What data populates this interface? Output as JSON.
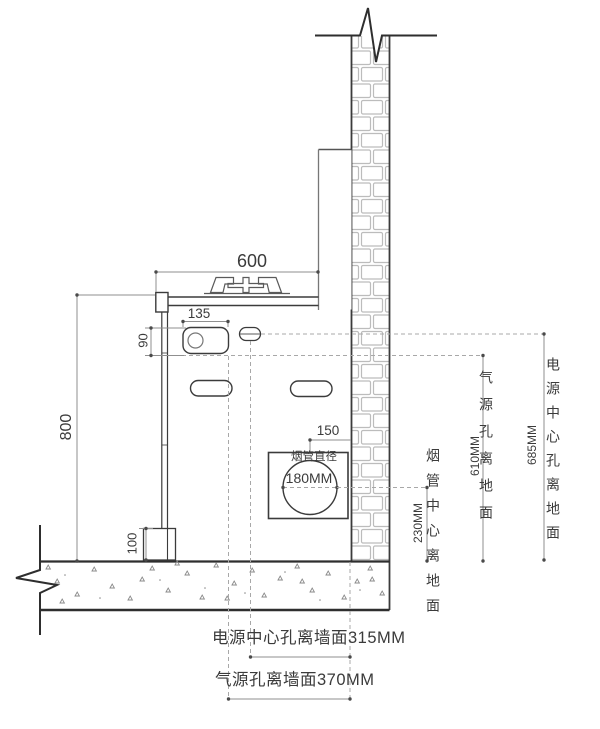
{
  "drawing": {
    "type": "installation-section-drawing",
    "dims": {
      "counter_width": "600",
      "valve_box_width": "135",
      "valve_box_height": "90",
      "counter_height": "800",
      "base_height": "100",
      "flue_center_to_wall": "150",
      "flue_diameter_title": "烟管直径",
      "flue_diameter_value": "180MM",
      "flue_center_height": "230MM",
      "gas_hole_height": "610MM",
      "power_hole_height": "685MM"
    },
    "annotations": {
      "flue_center_from_floor": "烟管中心离地面",
      "gas_hole_from_floor": "气源孔离地面",
      "power_hole_from_floor": "电源中心孔离地面",
      "power_hole_from_wall_note": "电源中心孔离墙面315MM",
      "gas_hole_from_wall_note": "气源孔离墙面370MM"
    },
    "colors": {
      "line_dark": "#3b3b3b",
      "line_mid": "#6f6f6f",
      "line_light": "#a5a5a5",
      "brick_mortar": "#bcbcbc",
      "background": "#ffffff"
    }
  }
}
